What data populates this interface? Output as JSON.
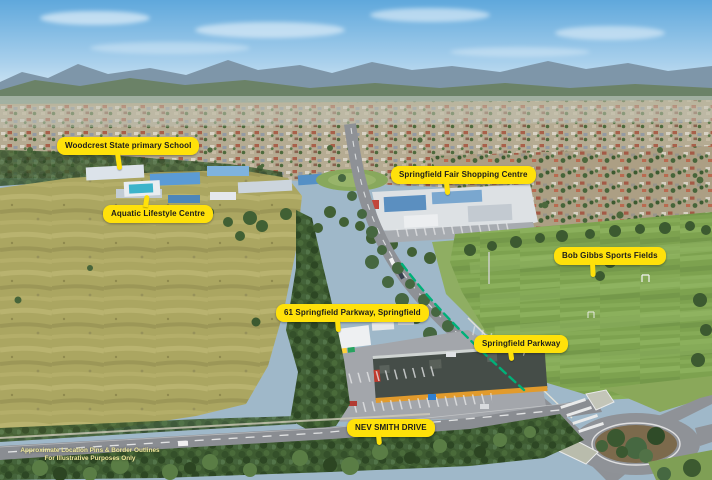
{
  "labels": {
    "woodcrest": "Woodcrest State primary School",
    "aquatic": "Aquatic Lifestyle Centre",
    "shopping": "Springfield Fair Shopping Centre",
    "sports": "Bob Gibbs Sports Fields",
    "property": "61 Springfield Parkway, Springfield",
    "parkway": "Springfield Parkway",
    "street": "NEV SMITH DRIVE"
  },
  "disclaimer": {
    "line1": "Approximate Location Pins & Border Outlines",
    "line2": "For Illustrative Purposes Only"
  },
  "colors": {
    "label_background": "#ffe10a",
    "label_text": "#1c1c1c",
    "boundary_dash_green": "#00b078"
  }
}
